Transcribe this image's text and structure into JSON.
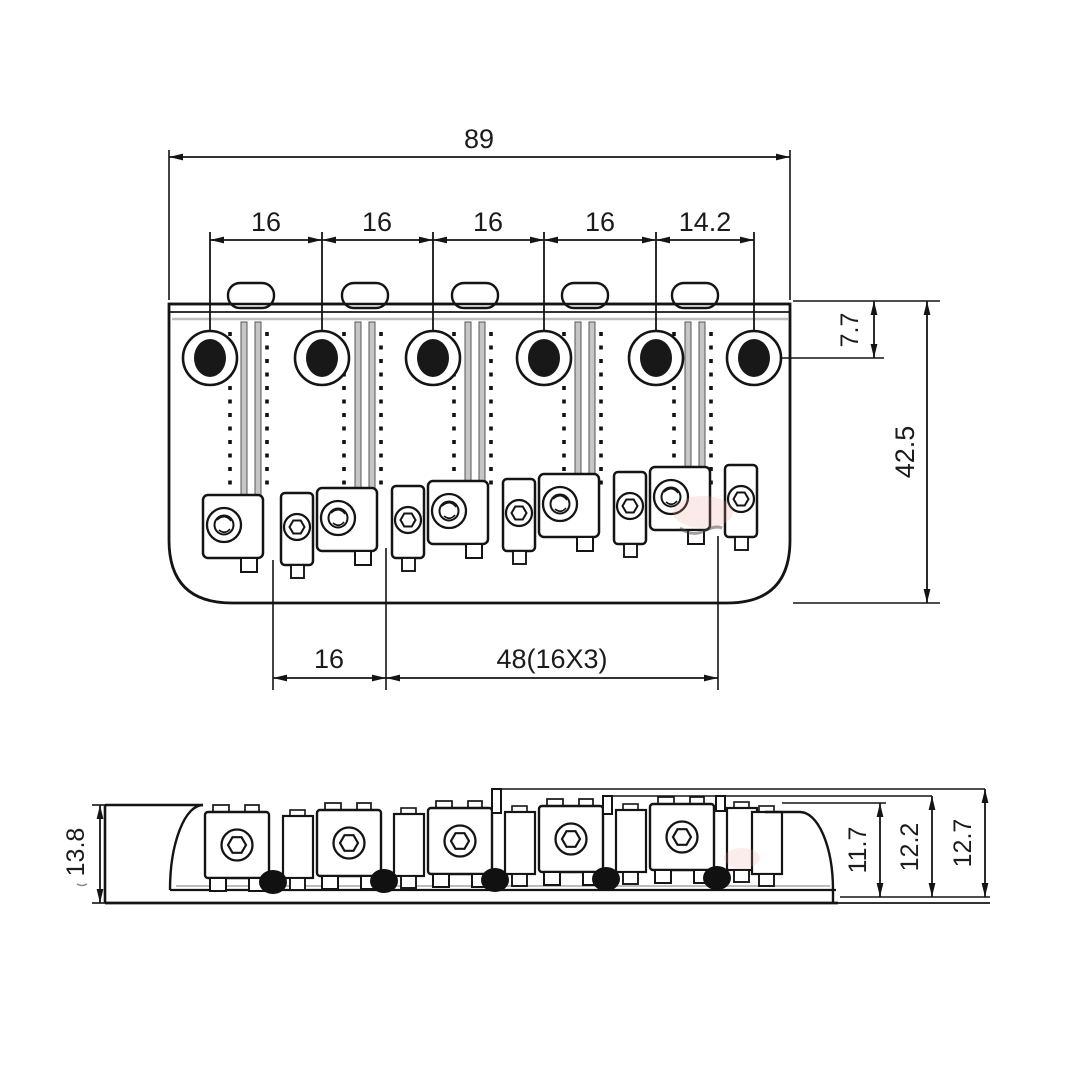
{
  "drawing": {
    "type": "technical-drawing",
    "subject": "6-saddle hardtail guitar bridge, top view and side view with dimensions (mm)",
    "top_view": {
      "overall_width": "89",
      "spacings": [
        "16",
        "16",
        "16",
        "16",
        "14.2"
      ],
      "edge_to_hole": "7.7",
      "overall_depth": "42.5",
      "saddle_pitch": "16",
      "saddle_span": "48(16X3)"
    },
    "side_view": {
      "overall_height": "13.8",
      "heights": [
        "11.7",
        "12.2",
        "12.7"
      ]
    },
    "line_color": "#141414",
    "background": "#ffffff"
  }
}
